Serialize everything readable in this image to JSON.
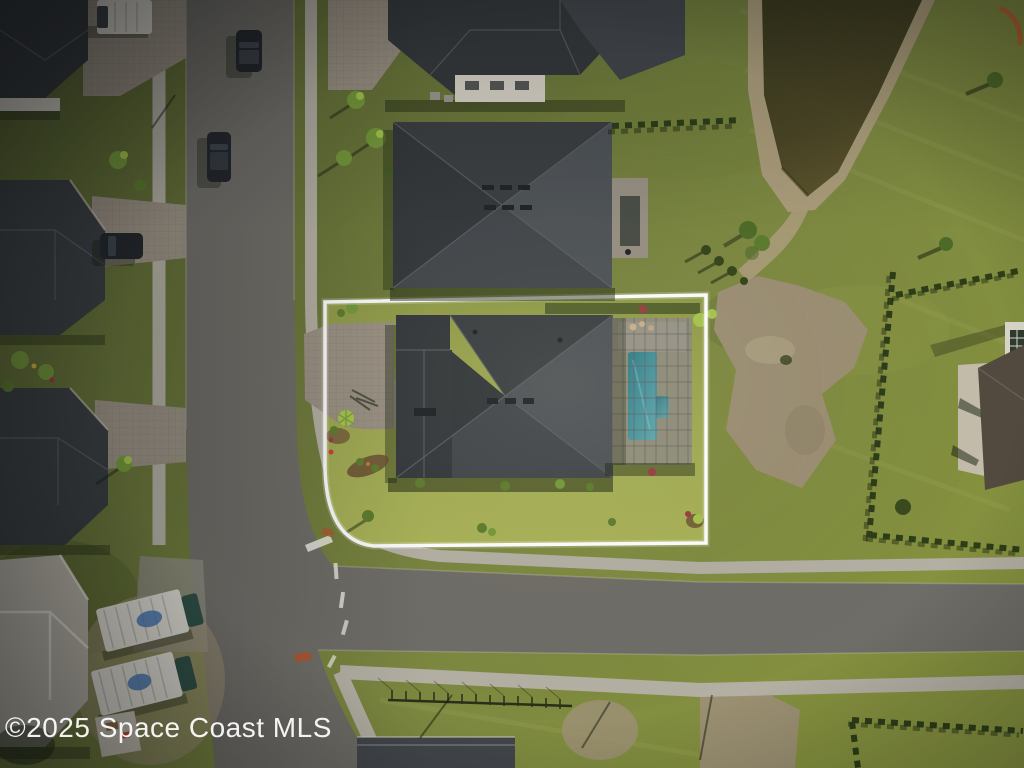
{
  "watermark": {
    "text": "©2025 Space Coast MLS"
  },
  "scene": {
    "type": "aerial-drone-photo",
    "objects": [
      "featured-lot-boundary",
      "featured-house-roof",
      "screened-pool-enclosure",
      "swimming-pool",
      "paver-driveway",
      "neighbor-house-center",
      "neighbor-house-top",
      "left-houses",
      "construction-house",
      "bottom-house",
      "right-edge-house",
      "retention-pond",
      "dirt-patch",
      "hedge-rows",
      "vertical-street",
      "main-street",
      "sidewalks",
      "suv-on-street",
      "parked-car",
      "white-van",
      "box-trucks",
      "lawn",
      "mls-watermark"
    ]
  },
  "colors": {
    "asphalt": "#6f6d67",
    "apron": "#8f8c82",
    "concrete": "#b3afa3",
    "paver-base": "#9a9183",
    "roof-dark": "#34383b",
    "roof-top": "#3a3e41",
    "roof-left": "#33373a",
    "roof-right": "#4d5256",
    "roof-bottom": "#42464a",
    "ridge": "#5a5f64",
    "wall-white": "#d8d3c7",
    "beige-wall": "#c3bcab",
    "brown-roof": "#52493f",
    "pond-water": "#46421f",
    "sand": "#ab9d7b",
    "dirt": "#9c8f74",
    "pool-water": "#3e8d98",
    "screen": "#8d8a82",
    "boundary-white": "#ffffff",
    "hedge-green": "#2c3d18",
    "bush-green": "#5d7c2e",
    "palm-green": "#74993a",
    "lime-green": "#a6c44d",
    "red-bush": "#9c3b44",
    "mulch": "#6b4e33",
    "vehicle-dark": "#22262a",
    "truck-white": "#dcd9d0",
    "truck-cab": "#2e4f46",
    "logo-blue": "#3f6fae",
    "marking-white": "#eceae2",
    "ramp-orange": "#b5542c",
    "watermark-white": "#ffffff"
  }
}
